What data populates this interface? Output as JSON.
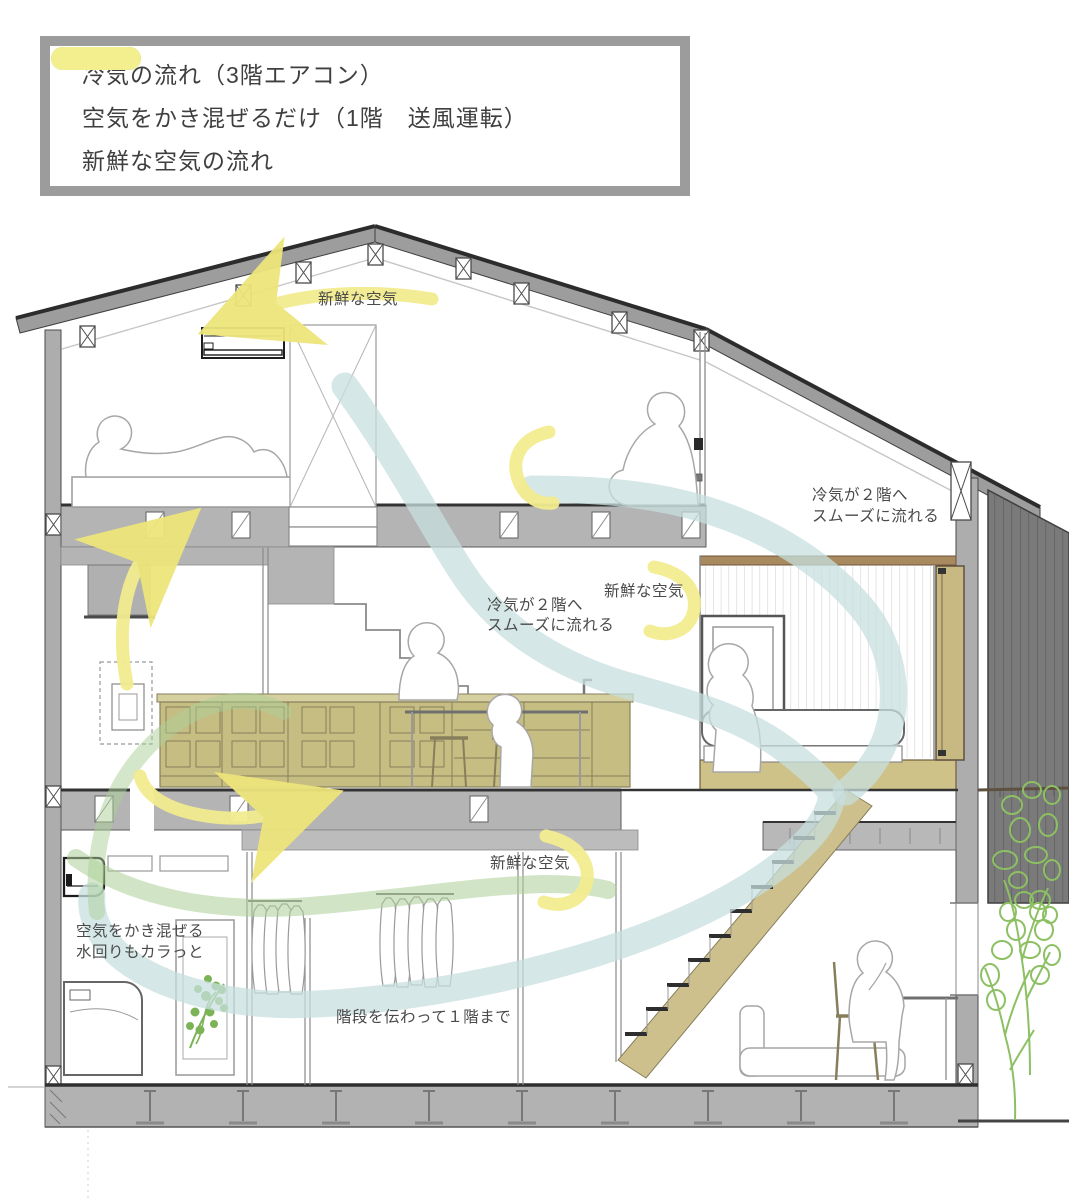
{
  "legend": {
    "items": [
      {
        "label": "冷気の流れ（3階エアコン）",
        "color": "#c5dcd9"
      },
      {
        "label": "空気をかき混ぜるだけ（1階　送風運転）",
        "color": "#a9cc96"
      },
      {
        "label": "新鮮な空気の流れ",
        "color": "#f3ee8e"
      }
    ]
  },
  "annotations": {
    "fresh_air_top": "新鮮な空気",
    "cold_to_2f_left_line1": "冷気が２階へ",
    "cold_to_2f_left_line2": "スムーズに流れる",
    "fresh_air_2f": "新鮮な空気",
    "cold_to_2f_right_line1": "冷気が２階へ",
    "cold_to_2f_right_line2": "スムーズに流れる",
    "fresh_air_1f": "新鮮な空気",
    "mix_air_line1": "空気をかき混ぜる",
    "mix_air_line2": "水回りもカラっと",
    "via_stairs_to_1f": "階段を伝わって１階まで"
  },
  "colors": {
    "flow_cold": "#c7dfdd",
    "flow_mix": "#abcf97",
    "flow_fresh": "#f2ec8f",
    "roof_gray": "#9d9d9d",
    "slab_gray": "#b4b4b4",
    "dark_panel": "#7a7a7a",
    "wood_tan": "#c6bd82",
    "tree_green": "#8cc063",
    "plant_green": "#7cb356",
    "legend_border": "#9c9c9c",
    "text": "#4a4a4a"
  }
}
